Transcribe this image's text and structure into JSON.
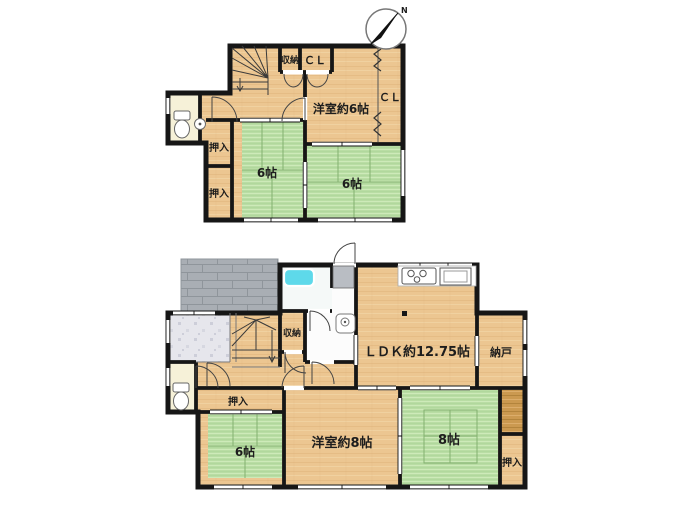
{
  "compass": {
    "north_label": "N"
  },
  "colors": {
    "wall": "#161616",
    "wood_floor": "#ecc691",
    "tatami_green": "#b9dda4",
    "tatami_line": "#84b170",
    "porch_gray": "#a9aeb4",
    "genkan_tile": "#e6e6ec",
    "bathtub_cyan": "#5ed9ea",
    "toilet_floor": "#f6f1d8",
    "dark_wood": "#cb9950",
    "appliance_gray": "#b9bdc3"
  },
  "floor2": {
    "rooms": {
      "storage": "収納",
      "closet_top": "ＣＬ",
      "western_room": "洋室約6帖",
      "closet_right": "ＣＬ",
      "oshiire_upper": "押入",
      "oshiire_lower": "押入",
      "tatami_left": "6帖",
      "tatami_right": "6帖"
    }
  },
  "floor1": {
    "rooms": {
      "storage": "収納",
      "ldk": "ＬＤＫ約12.75帖",
      "nando": "納戸",
      "oshiire_left": "押入",
      "tatami_6": "6帖",
      "western_room": "洋室約8帖",
      "tatami_8": "8帖",
      "oshiire_right": "押入"
    }
  }
}
